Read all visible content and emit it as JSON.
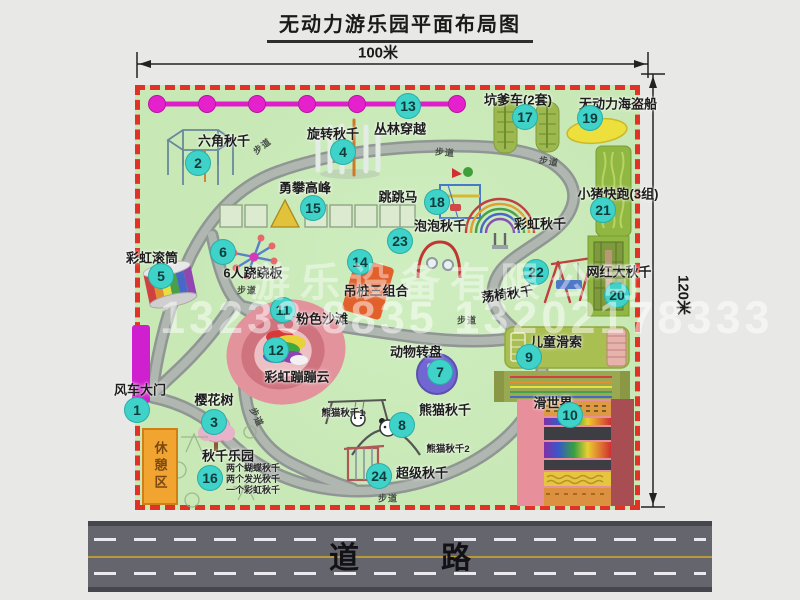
{
  "title": "无动力游乐园平面布局图",
  "dimensions": {
    "top": "100米",
    "right": "120米"
  },
  "road_label": "道　路",
  "rest_area_label": "休憩区",
  "walkway_label": "步道",
  "watermark": {
    "company": "游乐设备有限公司",
    "phone": "13233 8835 13202178333"
  },
  "attractions": [
    {
      "id": 1,
      "label": "风车大门"
    },
    {
      "id": 2,
      "label": "六角秋千"
    },
    {
      "id": 3,
      "label": "樱花树"
    },
    {
      "id": 4,
      "label": "旋转秋千"
    },
    {
      "id": 5,
      "label": "彩虹滚筒"
    },
    {
      "id": 6,
      "label": "6人跷跷板"
    },
    {
      "id": 7,
      "label": "动物转盘"
    },
    {
      "id": 8,
      "label": "熊猫秋千"
    },
    {
      "id": 9,
      "label": "儿童滑索"
    },
    {
      "id": 10,
      "label": "滑世界"
    },
    {
      "id": 11,
      "label": "粉色沙滩"
    },
    {
      "id": 12,
      "label": "彩虹蹦蹦云"
    },
    {
      "id": 13,
      "label": "丛林穿越"
    },
    {
      "id": 14,
      "label": "吊桩三组合"
    },
    {
      "id": 15,
      "label": "勇攀高峰"
    },
    {
      "id": 16,
      "label": "秋千乐园"
    },
    {
      "id": 17,
      "label": "坑爹车(2套)"
    },
    {
      "id": 18,
      "label": "跳跳马"
    },
    {
      "id": 19,
      "label": "无动力海盗船"
    },
    {
      "id": 20,
      "label": "网红大秋千"
    },
    {
      "id": 21,
      "label": "小猪快跑(3组)"
    },
    {
      "id": 22,
      "label": "荡椅秋千"
    },
    {
      "id": 23,
      "label": "泡泡秋千"
    },
    {
      "id": 24,
      "label": "超级秋千"
    }
  ],
  "secondary_labels": {
    "rainbow_swing": "彩虹秋千",
    "panda_swing_1": "熊猫秋千1",
    "panda_swing_2": "熊猫秋千2"
  },
  "swing_park_notes": [
    "两个蝴蝶秋千",
    "两个发光秋千",
    "一个彩虹秋千"
  ],
  "colors": {
    "park_fill": "#c8e8b6",
    "border_red": "#e03325",
    "badge_teal": "#3ed2c9",
    "zipline_magenta": "#e21fd0",
    "gate_magenta": "#cf1fce",
    "rest_area_orange": "#f2a431",
    "road_gray": "#65656d"
  }
}
